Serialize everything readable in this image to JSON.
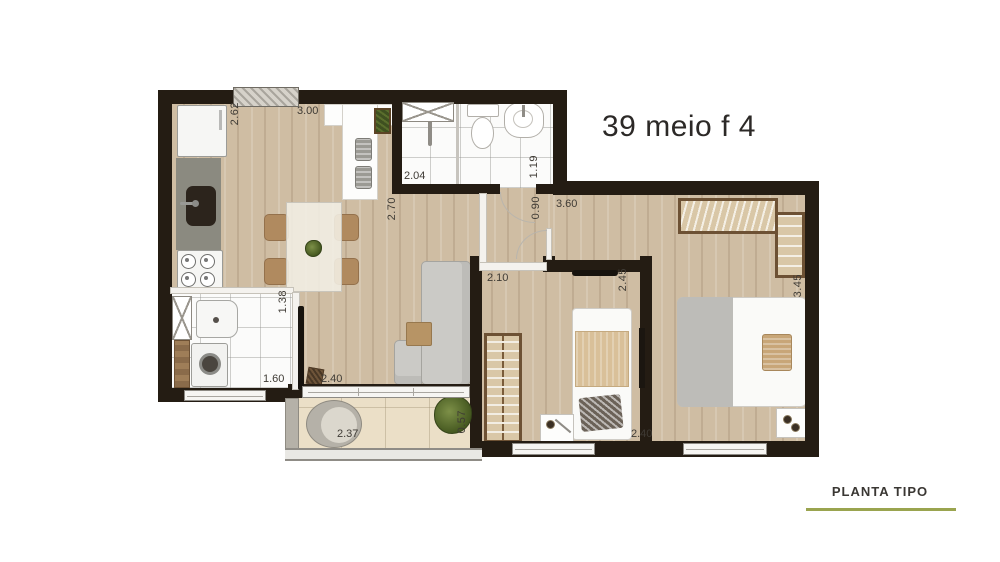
{
  "header": {
    "title": "39 meio f 4"
  },
  "footer": {
    "label": "PLANTA TIPO",
    "accent_color": "#9aa44f",
    "rule_style": "background:#9aa44f"
  },
  "dimensions": {
    "kitchen_height": "2.62",
    "kitchen_width": "3.00",
    "bathroom_width": "2.04",
    "bathroom_depth": "1.19",
    "kitchen_depth": "2.70",
    "hall_width": "0.90",
    "master_width": "3.60",
    "bedroom2_width": "2.10",
    "bedroom2_depth": "2.45",
    "master_depth": "3.45",
    "service_depth": "1.38",
    "service_width": "1.60",
    "living_width": "2.40",
    "balcony_width": "2.37",
    "balcony_depth": "0.57",
    "master_bottom_width": "2.40"
  },
  "colors": {
    "wall": "#241c13",
    "wood_floor": "#cfbda3",
    "tile_floor": "#fbfbfa",
    "balcony_floor": "#ebdfc7",
    "accent": "#9aa44f"
  }
}
